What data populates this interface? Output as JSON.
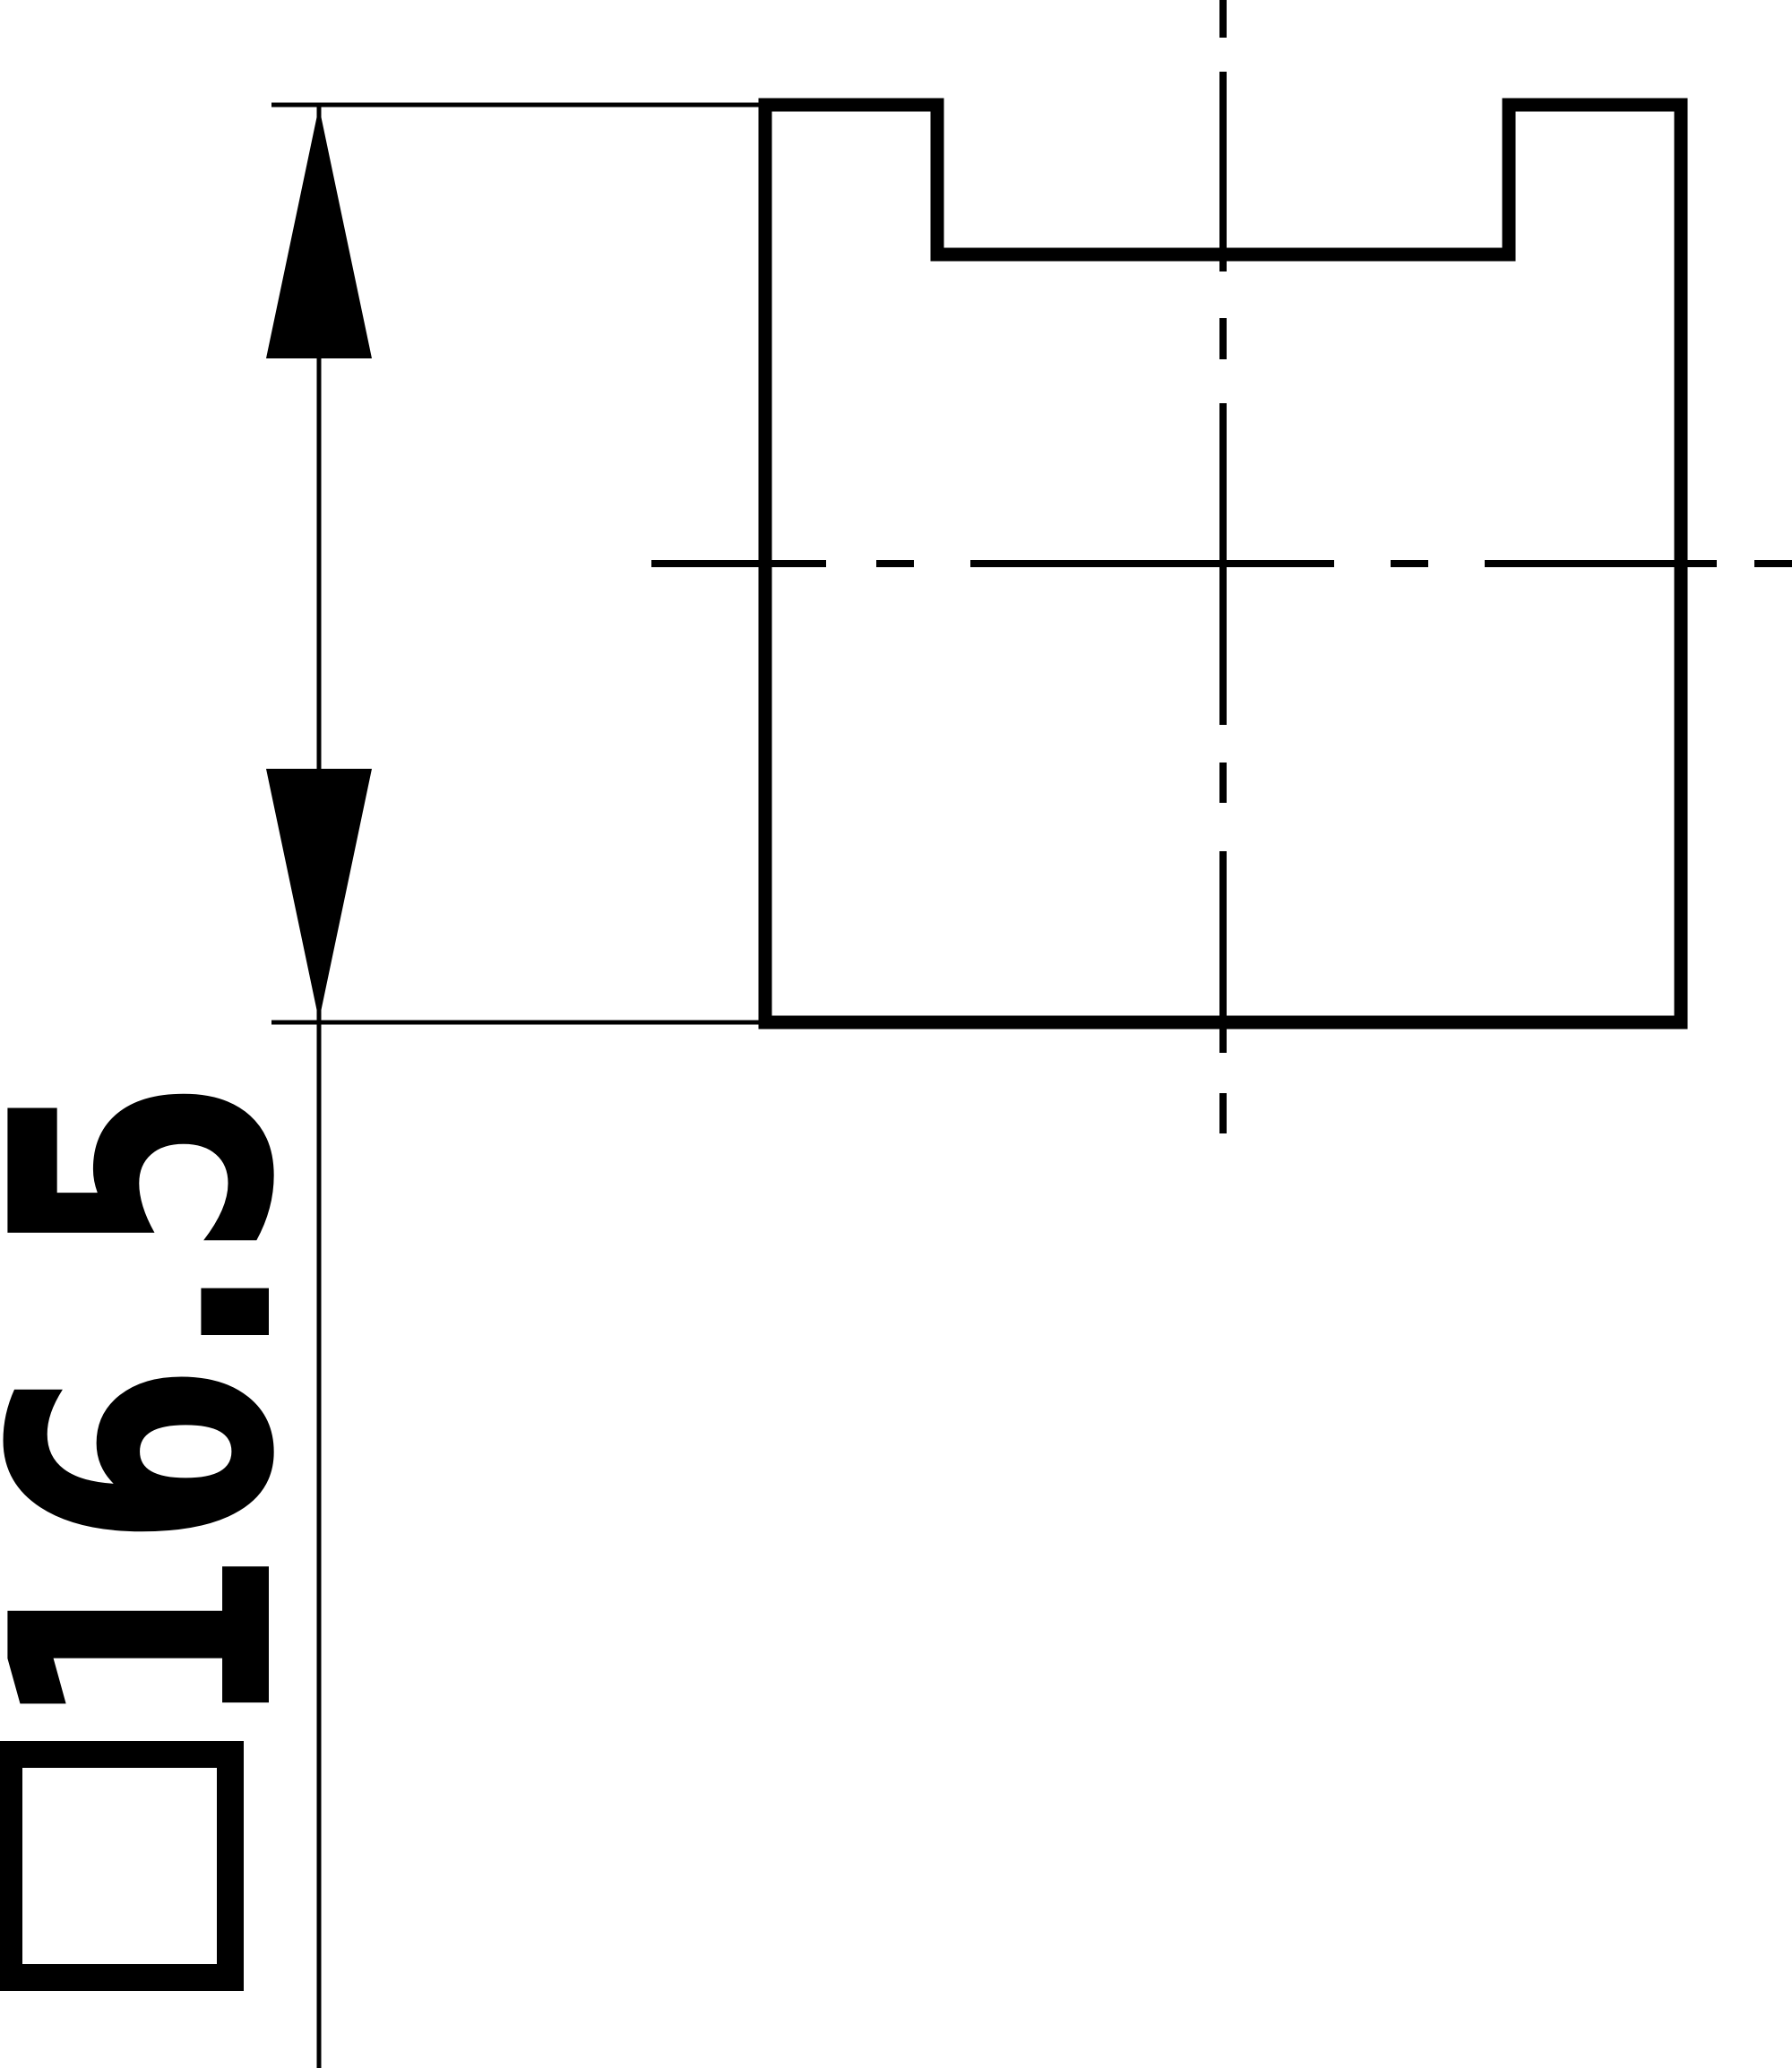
{
  "canvas": {
    "background_color": "#ffffff",
    "line_color": "#000000"
  },
  "dimension_label": {
    "symbol_icon": "square-symbol",
    "symbol_glyph": "□",
    "value_text": "16.5",
    "combined_label": "□16.5",
    "orientation": "rotated-90-ccw"
  },
  "drawing_elements": {
    "part": "square-block-with-top-notch",
    "dimension_measured": "overall-height",
    "dimension_value": 16.5,
    "centerlines": [
      "vertical-centerline",
      "horizontal-centerline"
    ]
  }
}
